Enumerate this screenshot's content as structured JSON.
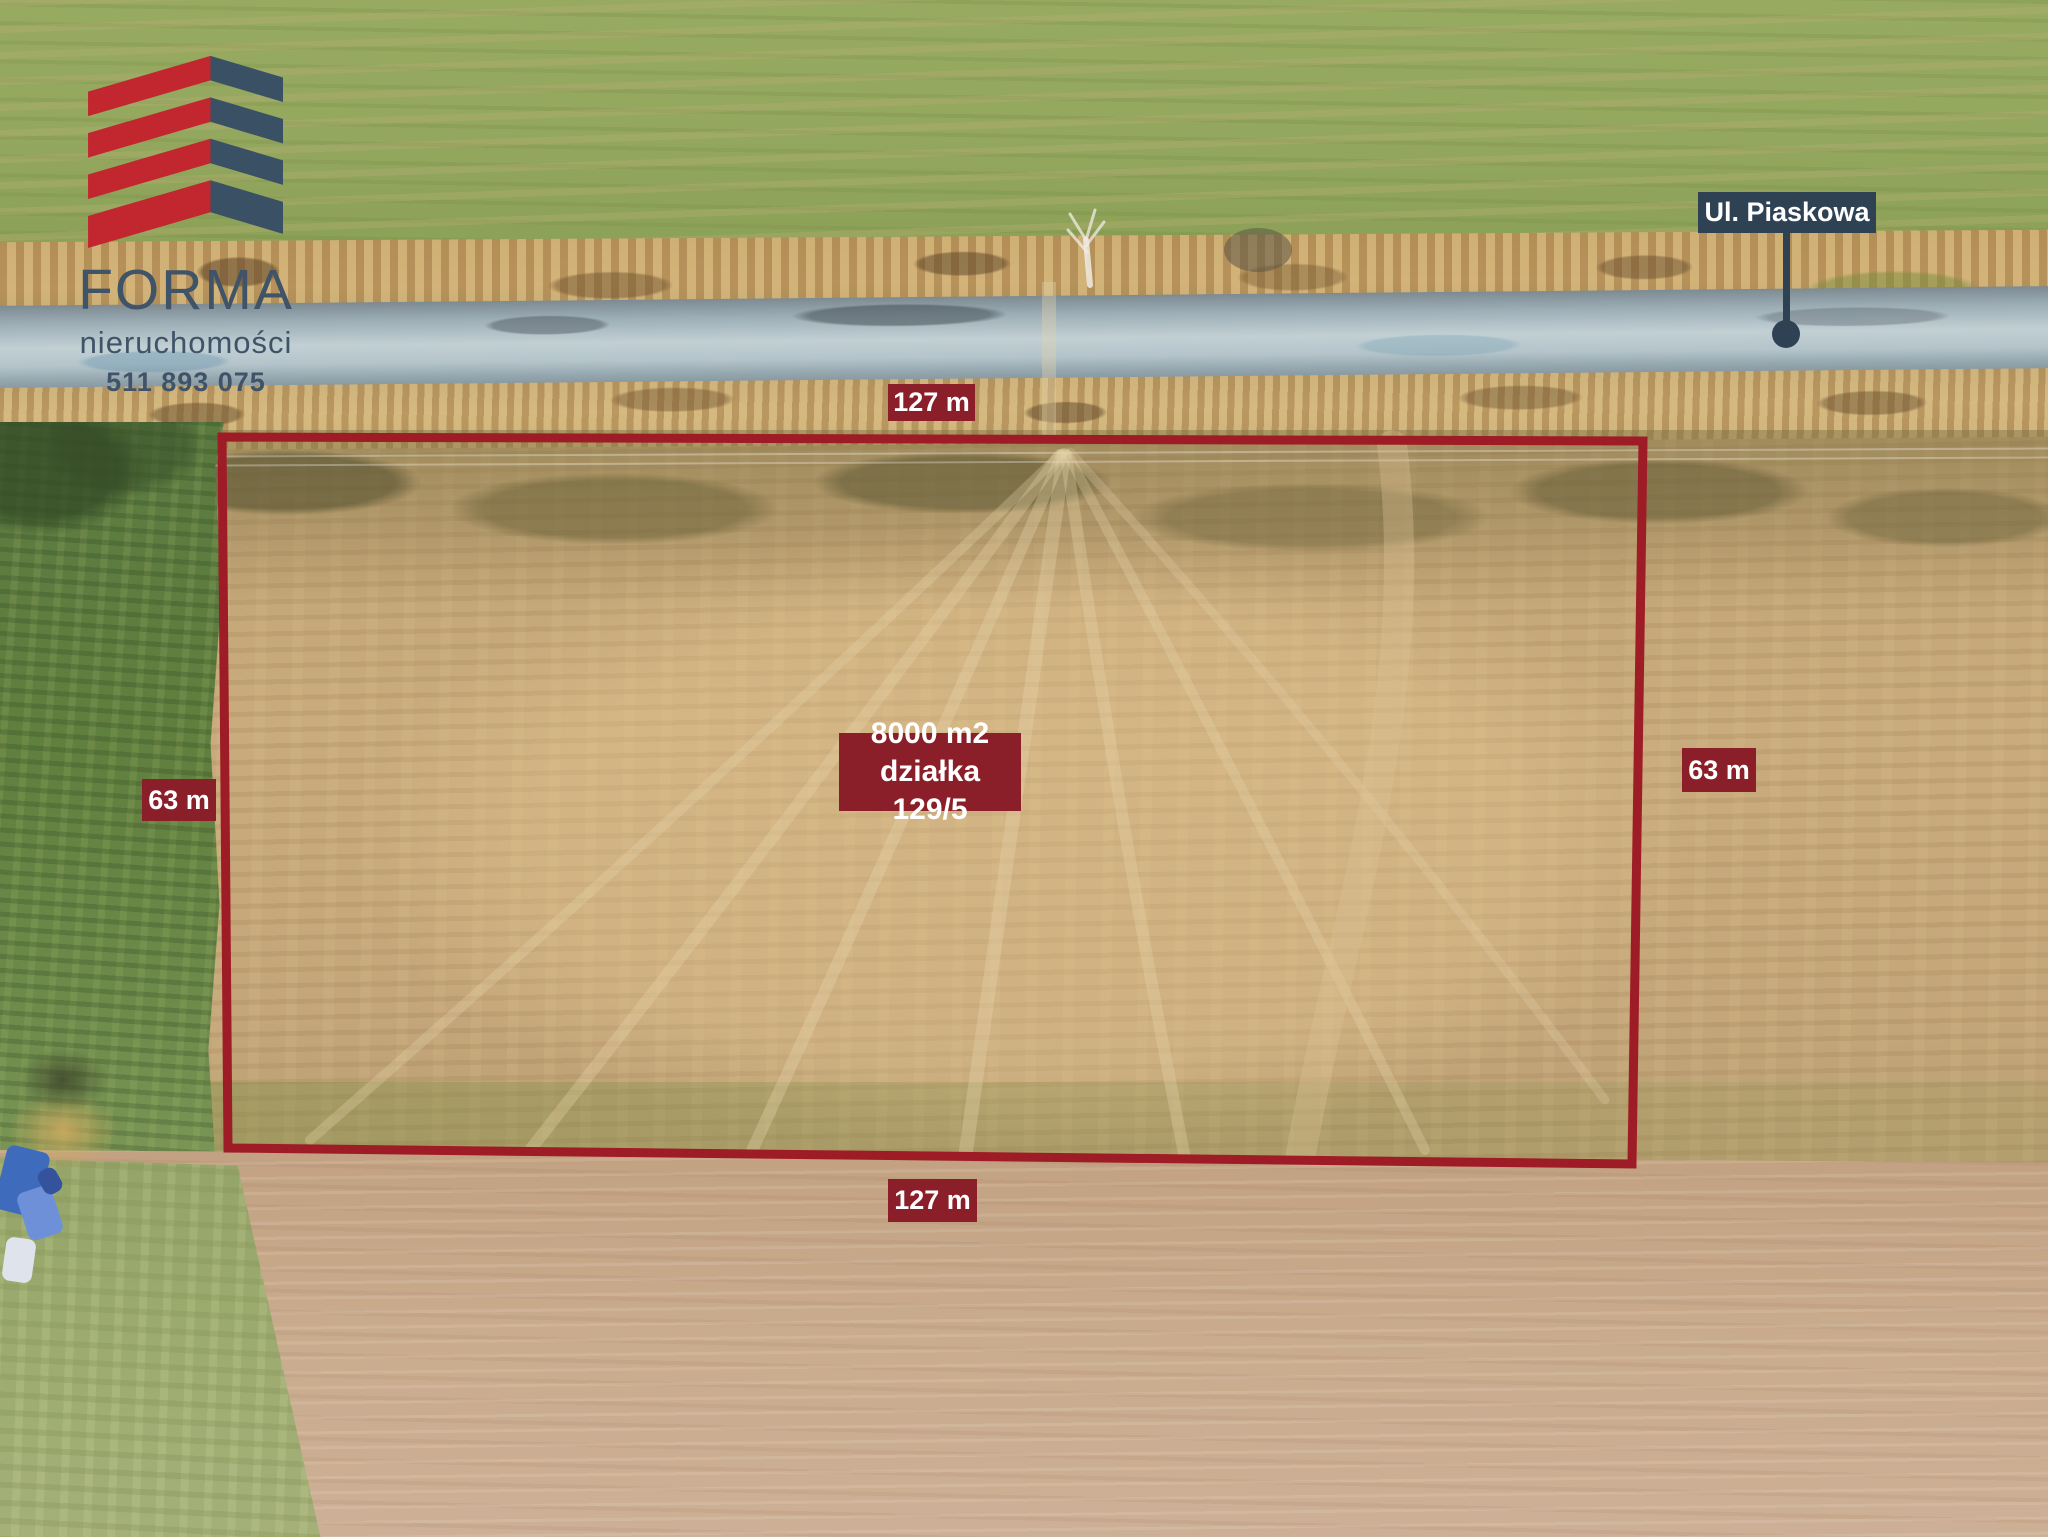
{
  "colors": {
    "accent-red": "#8b1f29",
    "boundary-red": "#9e1c26",
    "slate": "#2e4254",
    "logo-red": "#c2262e",
    "logo-slate": "#3a5064",
    "logo-text": "#3f5468",
    "label-text": "#ffffff"
  },
  "logo": {
    "brand": "FORMA",
    "tagline": "nieruchomości",
    "phone": "511 893 075"
  },
  "street": {
    "label": "Ul. Piaskowa"
  },
  "plot": {
    "area": "8000 m2",
    "parcel": "działka 129/5",
    "dim_top": "127 m",
    "dim_bottom": "127 m",
    "dim_left": "63 m",
    "dim_right": "63 m"
  }
}
